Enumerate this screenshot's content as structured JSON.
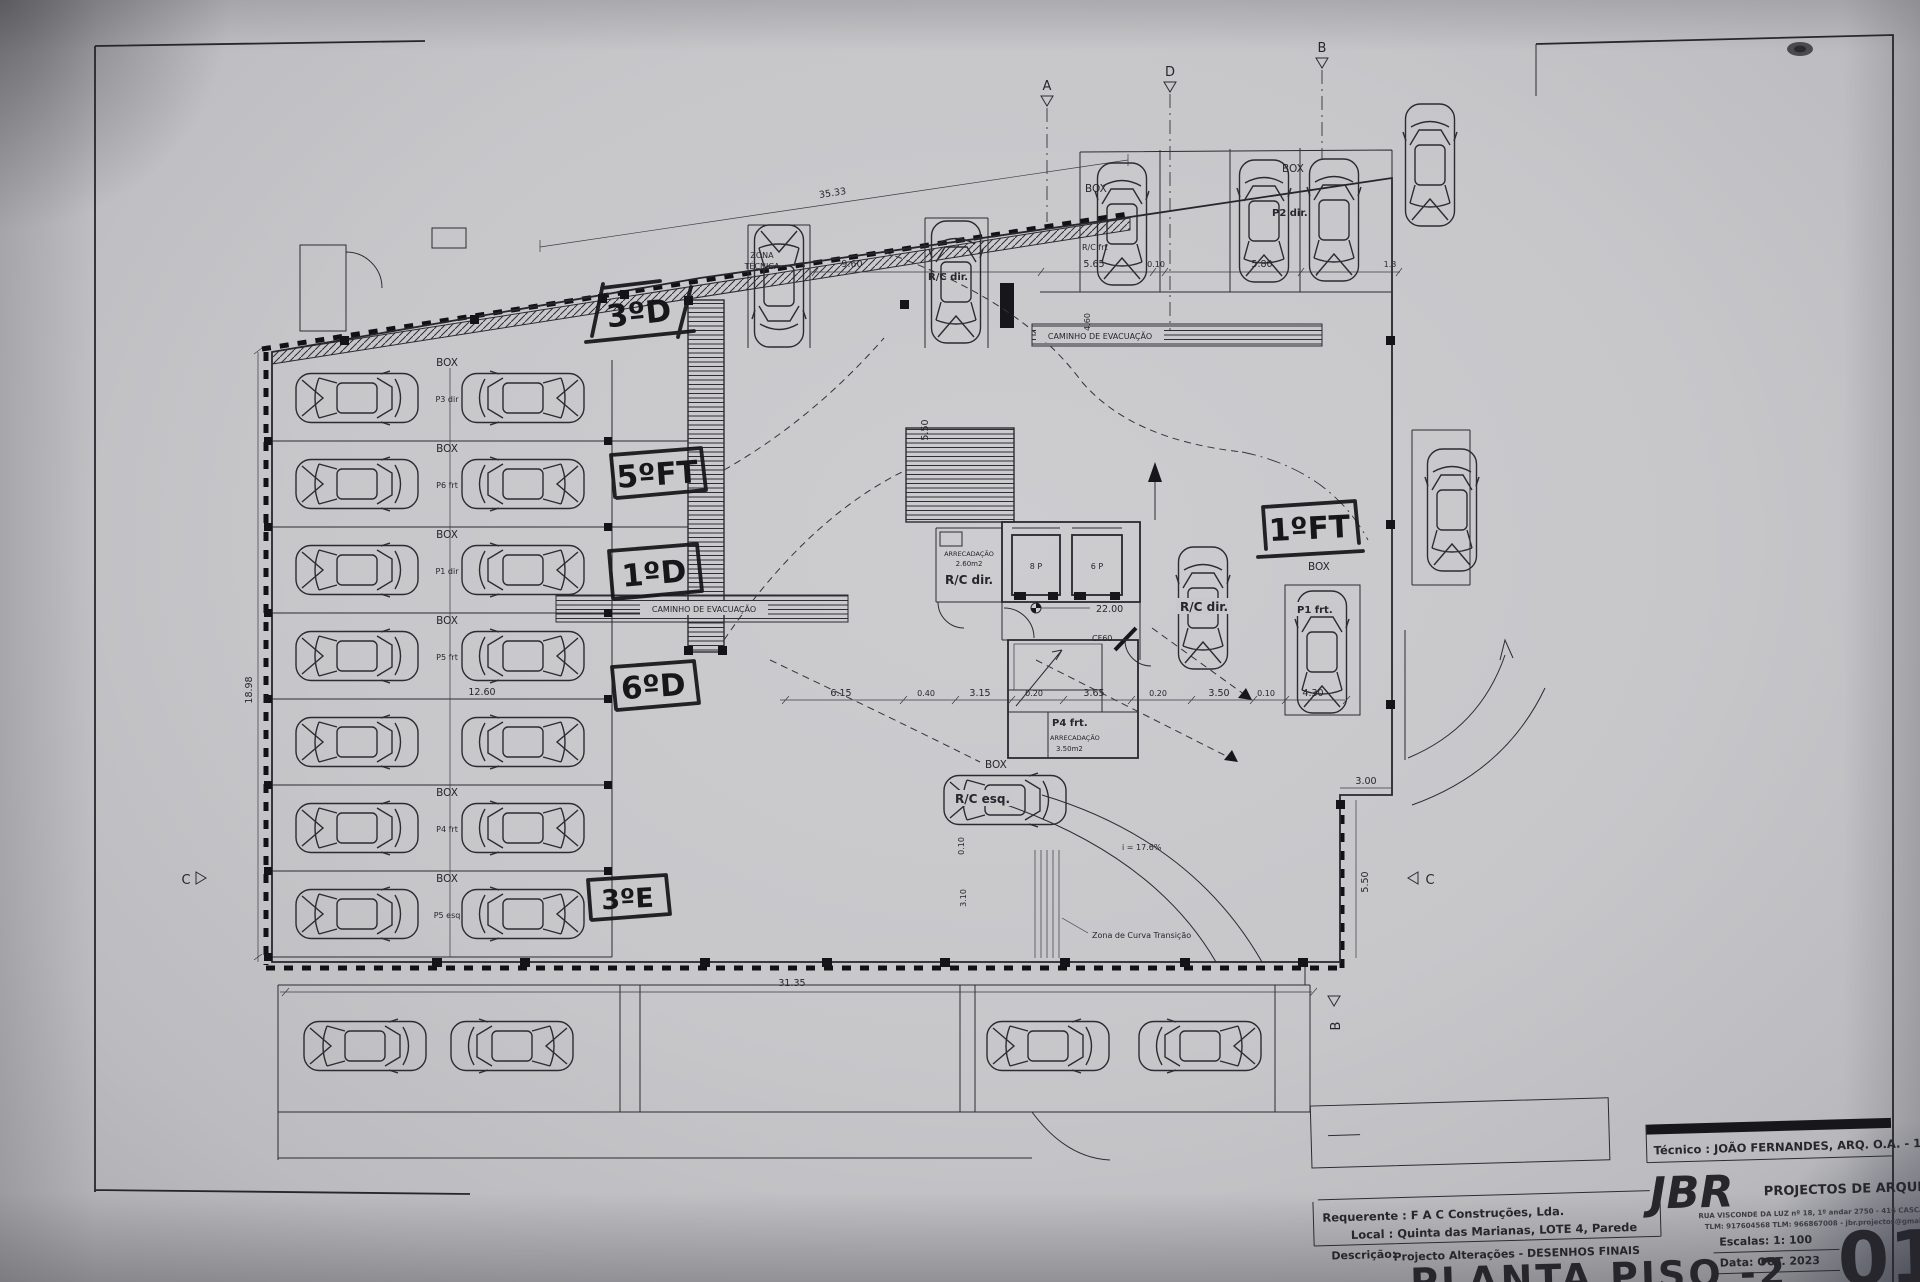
{
  "title_block": {
    "tecnico": "Técnico : JOÃO FERNANDES, ARQ.   O.A. - 11976",
    "firm_initials": "JBR",
    "firm_name": "PROJECTOS DE ARQUITECTURA",
    "firm_address": "RUA VISCONDE DA LUZ nº 18, 1º andar  2750 - 416  CASCAIS",
    "firm_contacts": "TLM: 917604568  TLM: 966867008 - jbr.projectos@gmail.com",
    "requerente_label": "Requerente : ",
    "requerente": "F A C  Construções, Lda.",
    "local_label": "Local : ",
    "local": "Quinta das Marianas, LOTE 4, Parede",
    "descricao_label": "Descrição:",
    "descricao": "Projecto Alterações - DESENHOS FINAIS",
    "escala": "Escalas:  1: 100",
    "data": "Data: OUT.  2023",
    "drawing_title": "PLANTA PISO -2",
    "sheet_number": "01"
  },
  "handwritten": {
    "a1": "3ºD",
    "a2": "5ºFT",
    "a3": "1ºD",
    "a4": "6ºD",
    "a5": "3ºE",
    "a6": "1ºFT"
  },
  "labels": {
    "box": "BOX",
    "zona_1": "ZONA",
    "zona_2": "TÉCNICA",
    "caminho": "CAMINHO DE EVACUAÇÃO",
    "rc_frt": "R/C frt",
    "rc_dir": "R/C dir.",
    "rc_esq": "R/C esq.",
    "p2_dir": "P2 dir.",
    "p1_frt": "P1 frt.",
    "p4_frt": "P4 frt.",
    "arrecadacao": "ARRECADAÇÃO",
    "arrec_area_1": "2.60m2",
    "arrec_area_2": "3.50m2",
    "lift_8p": "8 P",
    "lift_6p": "6 P",
    "level": "22.00",
    "cf60": "CF60",
    "slope": "i = 17.6%",
    "curva": "Zona de Curva Transição"
  },
  "left_rows": [
    {
      "box": "BOX",
      "p": "P3 dir"
    },
    {
      "box": "BOX",
      "p": "P6 frt"
    },
    {
      "box": "BOX",
      "p": "P1 dir"
    },
    {
      "box": "BOX",
      "p": "P5 frt"
    },
    {
      "box": "",
      "p": ""
    },
    {
      "box": "BOX",
      "p": "P4 frt"
    },
    {
      "box": "BOX",
      "p": "P5 esq"
    }
  ],
  "dims": {
    "top": "35.33",
    "bottom": "31.35",
    "left_h": "18.98",
    "d960": "9.60",
    "d565": "5.65",
    "d010": "0.10",
    "d580": "5.80",
    "d130": "1.3",
    "d1260": "12.60",
    "d615": "6.15",
    "d040": "0.40",
    "d315": "3.15",
    "d020a": "0.20",
    "d365": "3.65",
    "d020b": "0.20",
    "d350": "3.50",
    "d010b": "0.10",
    "d430": "4.30",
    "d300": "3.00",
    "d550": "5.50",
    "d550t": "5.50",
    "d460": "4.60",
    "d310": "3.10",
    "d010c": "0.10"
  },
  "markers": {
    "a": "A",
    "b": "B",
    "c": "C",
    "d": "D"
  }
}
